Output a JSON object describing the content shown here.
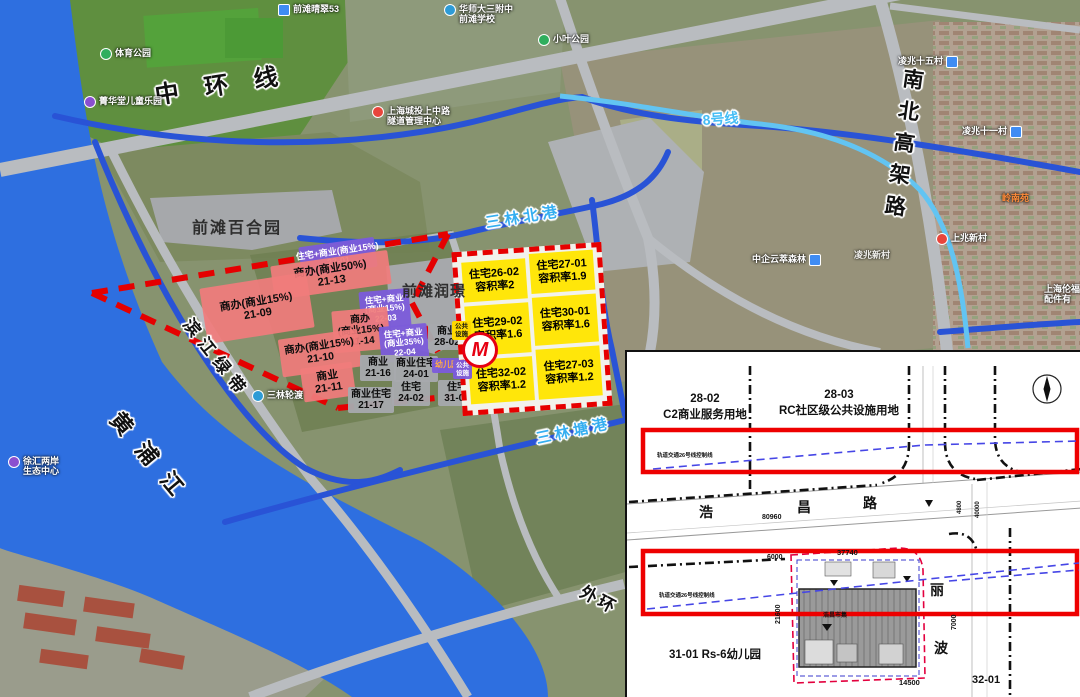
{
  "map": {
    "areas": {
      "baiheyuan": "前滩百合园",
      "runjing": "前滩润璟"
    },
    "roads": {
      "zhonghuanxian": "中环线",
      "nanbeigaojialu": "南北高架路",
      "line8": "8号线",
      "waihuan": "外环"
    },
    "waters": {
      "huangpujiang": "黄浦江",
      "sanlinbeigang": "三林北港",
      "sanlintanggang": "三林塘港",
      "binjianglvdai": "滨江绿带"
    },
    "metro_logo": "M",
    "parcels": [
      {
        "lines": [
          "住宅+商业(商业15%)",
          "22-01"
        ]
      },
      {
        "lines": [
          "商办(商业50%)",
          "21-13"
        ]
      },
      {
        "lines": [
          "商办(商业15%)",
          "21-09"
        ]
      },
      {
        "lines": [
          "住宅+商业",
          "(商业15%)",
          "22-03"
        ]
      },
      {
        "lines": [
          "商办",
          "(商业15%)",
          "21-14"
        ]
      },
      {
        "lines": [
          "住宅+商业",
          "(商业35%)",
          "22-04"
        ]
      },
      {
        "lines": [
          "商办(商业15%)",
          "21-10"
        ]
      },
      {
        "lines": [
          "商业",
          "21-11"
        ]
      },
      {
        "lines": [
          "商业",
          "21-16"
        ]
      },
      {
        "lines": [
          "商业住宅",
          "21-17"
        ]
      },
      {
        "lines": [
          "商业住宅",
          "24-01"
        ]
      },
      {
        "lines": [
          "住宅",
          "24-02"
        ]
      },
      {
        "lines": [
          "住宅",
          "31-02"
        ]
      },
      {
        "lines": [
          "商业",
          "28-02"
        ]
      },
      {
        "lines": [
          "幼儿园"
        ]
      },
      {
        "lines": [
          "公共",
          "设施"
        ]
      },
      {
        "lines": [
          "公共",
          "设施"
        ]
      },
      {
        "lines": [
          "住宅26-02",
          "容积率2"
        ]
      },
      {
        "lines": [
          "住宅27-01",
          "容积率1.9"
        ]
      },
      {
        "lines": [
          "住宅29-02",
          "容积率1.6"
        ]
      },
      {
        "lines": [
          "住宅30-01",
          "容积率1.6"
        ]
      },
      {
        "lines": [
          "住宅32-02",
          "容积率1.2"
        ]
      },
      {
        "lines": [
          "住宅27-03",
          "容积率1.2"
        ]
      }
    ],
    "pois": [
      {
        "lines": [
          "前滩晴翠53"
        ]
      },
      {
        "lines": [
          "华师大三附中",
          "前滩学校"
        ]
      },
      {
        "lines": [
          "小叶公园"
        ]
      },
      {
        "lines": [
          "上海城投上中路",
          "隧道管理中心"
        ]
      },
      {
        "lines": [
          "体育公园"
        ]
      },
      {
        "lines": [
          "菁华堂儿童乐园"
        ]
      },
      {
        "lines": [
          "凌兆十五村"
        ]
      },
      {
        "lines": [
          "凌兆十一村"
        ]
      },
      {
        "lines": [
          "岭南苑"
        ]
      },
      {
        "lines": [
          "凌兆新村"
        ]
      },
      {
        "lines": [
          "上兆新村"
        ]
      },
      {
        "lines": [
          "中企云萃森林"
        ]
      },
      {
        "lines": [
          "上海伦福",
          "配件有"
        ]
      },
      {
        "lines": [
          "徐汇两岸",
          "生态中心"
        ]
      },
      {
        "lines": [
          "三林轮渡"
        ]
      }
    ]
  },
  "inset": {
    "parcel2802_code": "28-02",
    "parcel2802_use": "C2商业服务用地",
    "parcel2803_code": "28-03",
    "parcel2803_use": "RC社区级公共设施用地",
    "rail_line_label": "轨道交通26号线控制线",
    "haochang": [
      "浩",
      "昌",
      "路"
    ],
    "libo": [
      "丽",
      "波"
    ],
    "kindergarten_label": "31-01 Rs-6幼儿园",
    "parcel3201": "32-01",
    "building_label": "浩昌市集",
    "dims": {
      "d80960": "80960",
      "d6000": "6000",
      "d37740": "37740",
      "d21600": "21600",
      "d14500": "14500",
      "d7000": "7000",
      "d4800": "4800",
      "d40000": "40000"
    }
  }
}
